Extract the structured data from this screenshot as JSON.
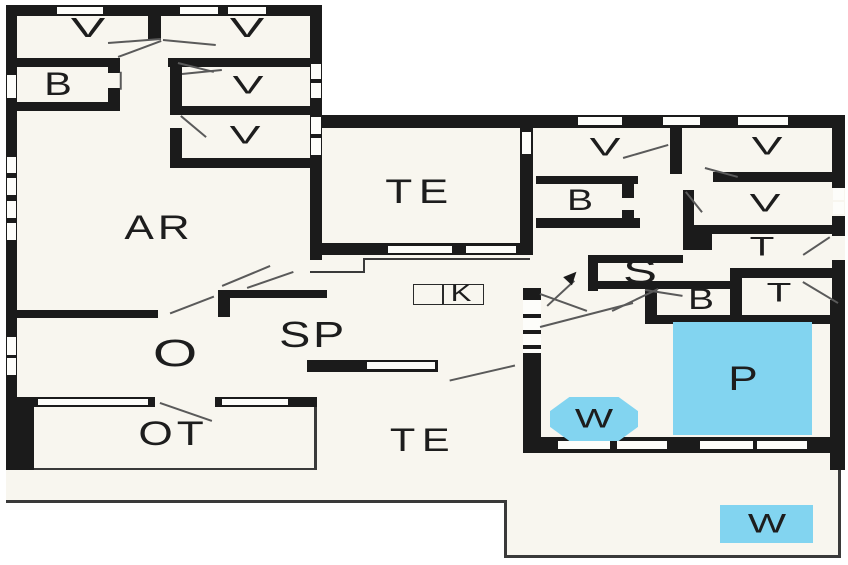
{
  "plan": {
    "rooms": [
      {
        "id": "v1",
        "label": "V"
      },
      {
        "id": "v2",
        "label": "V"
      },
      {
        "id": "b1",
        "label": "B"
      },
      {
        "id": "v3",
        "label": "V"
      },
      {
        "id": "v4",
        "label": "V"
      },
      {
        "id": "ar",
        "label": "AR"
      },
      {
        "id": "te_top",
        "label": "TE"
      },
      {
        "id": "o",
        "label": "O"
      },
      {
        "id": "sp",
        "label": "SP"
      },
      {
        "id": "k",
        "label": "K"
      },
      {
        "id": "ot",
        "label": "OT"
      },
      {
        "id": "te_bottom",
        "label": "TE"
      },
      {
        "id": "v5",
        "label": "V"
      },
      {
        "id": "v6",
        "label": "V"
      },
      {
        "id": "b2",
        "label": "B"
      },
      {
        "id": "v7",
        "label": "V"
      },
      {
        "id": "t1",
        "label": "T"
      },
      {
        "id": "s",
        "label": "S"
      },
      {
        "id": "b3",
        "label": "B"
      },
      {
        "id": "t2",
        "label": "T"
      },
      {
        "id": "p",
        "label": "P"
      },
      {
        "id": "w1",
        "label": "W"
      },
      {
        "id": "w2",
        "label": "W"
      }
    ],
    "colors": {
      "wall": "#1b1b1b",
      "floor": "#f8f6ef",
      "water": "#82d4f0",
      "door_line": "#5a5a5a",
      "background": "#ffffff"
    }
  }
}
